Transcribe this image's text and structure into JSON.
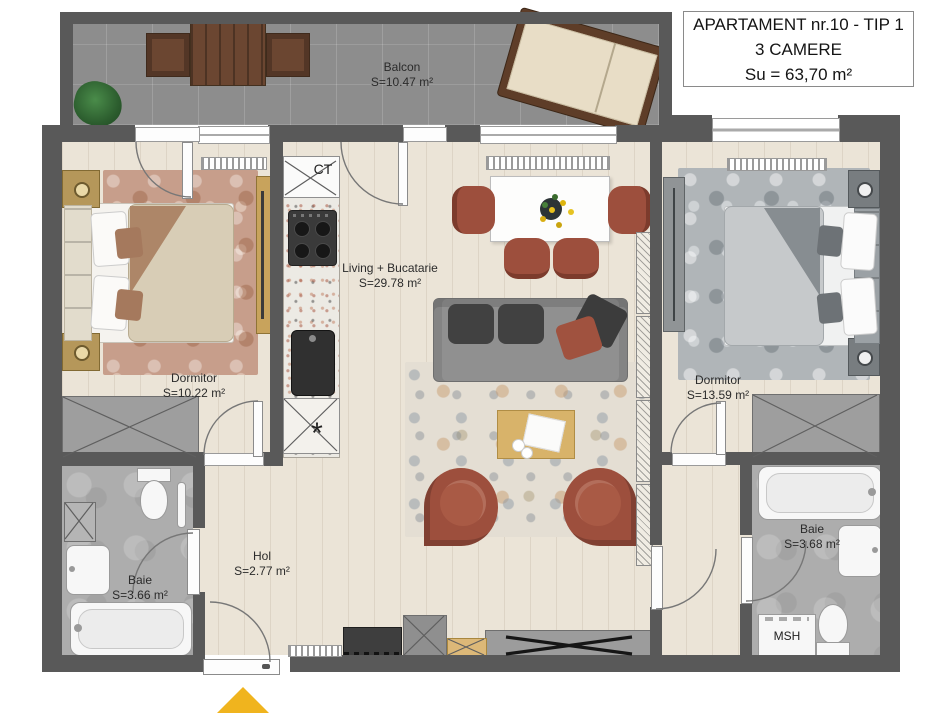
{
  "title": {
    "line1": "APARTAMENT nr.10 - TIP 1",
    "line2": "3 CAMERE",
    "line3": "Su = 63,70 m²"
  },
  "rooms": {
    "balcony": {
      "name": "Balcon",
      "area": "S=10.47 m²"
    },
    "bedroom_left": {
      "name": "Dormitor",
      "area": "S=10.22 m²"
    },
    "living": {
      "name": "Living + Bucatarie",
      "area": "S=29.78 m²"
    },
    "bedroom_right": {
      "name": "Dormitor",
      "area": "S=13.59 m²"
    },
    "bathroom_left": {
      "name": "Baie",
      "area": "S=3.66 m²"
    },
    "hall": {
      "name": "Hol",
      "area": "S=2.77 m²"
    },
    "bathroom_right": {
      "name": "Baie",
      "area": "S=3.68 m²"
    }
  },
  "annotations": {
    "boiler": "CT",
    "washing_machine": "MSH",
    "star": "*"
  },
  "colors": {
    "wall": "#595959",
    "terracotta_accent": "#9d4f3d",
    "entrance_arrow": "#f0b41e",
    "wood_floor": "#ebe4d7",
    "balcony_tile": "#8d8d8d"
  }
}
